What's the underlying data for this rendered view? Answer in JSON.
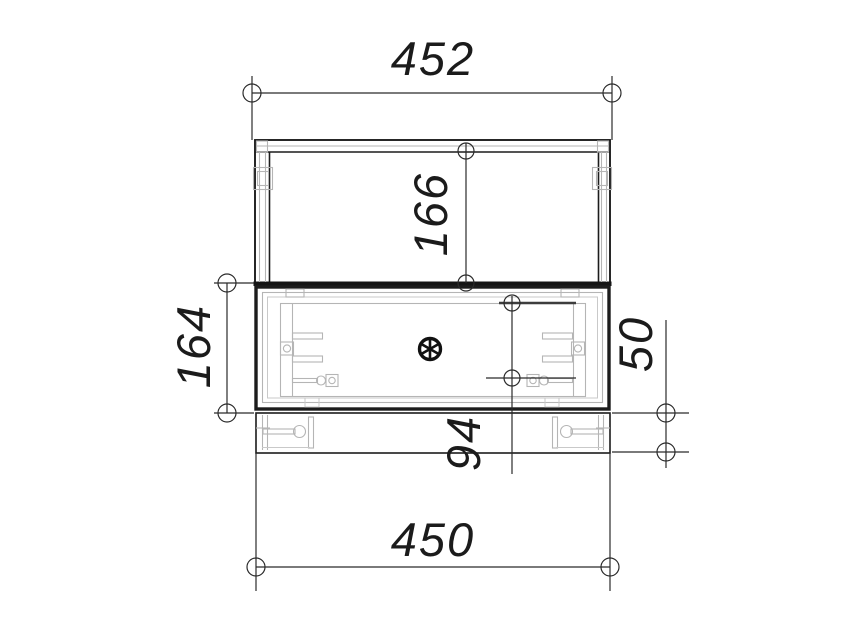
{
  "drawing": {
    "view": "cabinet-front-elevation",
    "dimensions": {
      "overall_width_top": "452",
      "upper_door_height": "166",
      "middle_section_height": "164",
      "drawer_opening_height": "94",
      "plinth_height": "50",
      "overall_width_bottom": "450"
    },
    "colors": {
      "background": "#ffffff",
      "outline": "#1c1c1c",
      "dimension_line": "#2b2b2b",
      "hidden_detail_gray": "#b5b5b5"
    },
    "icons": {
      "dimension_terminator": "open-circle",
      "center_symbol": "spoked-wheel"
    }
  }
}
